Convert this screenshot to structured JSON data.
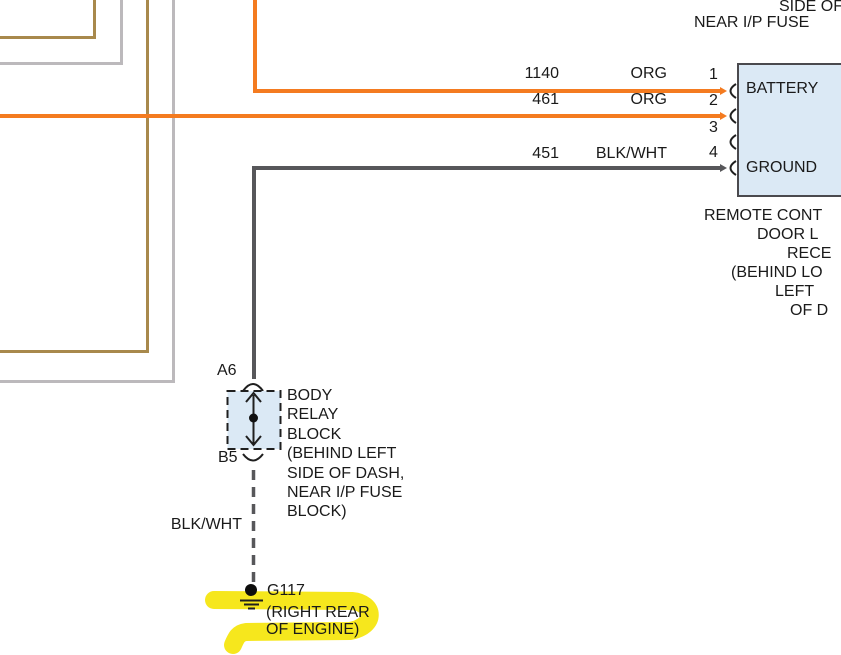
{
  "colors": {
    "orange": "#F47B20",
    "tan": "#A8894C",
    "light_gray": "#BCB9BC",
    "dark_gray": "#57575A",
    "box_fill": "#DBE9F5",
    "box_border": "#4A4A4E",
    "line_black": "#1F1F1F",
    "highlight_yellow": "#F5E50A",
    "text": "#1A1A1A"
  },
  "top_note": {
    "line1": "SIDE OF",
    "line2": "NEAR I/P FUSE"
  },
  "receiver": {
    "pin1_label": "BATTERY",
    "pin4_label": "GROUND",
    "pins": [
      {
        "num": "1",
        "circuit": "1140",
        "wire_color": "ORG"
      },
      {
        "num": "2",
        "circuit": "461",
        "wire_color": "ORG"
      },
      {
        "num": "3",
        "circuit": "",
        "wire_color": ""
      },
      {
        "num": "4",
        "circuit": "451",
        "wire_color": "BLK/WHT"
      }
    ],
    "caption_lines": [
      "REMOTE CONT",
      "DOOR L",
      "RECE",
      "(BEHIND LO",
      "LEFT",
      "OF D"
    ]
  },
  "body_relay_block": {
    "top_pin": "A6",
    "bottom_pin": "B5",
    "label_lines": [
      "BODY",
      "RELAY",
      "BLOCK",
      "(BEHIND LEFT",
      "SIDE OF DASH,",
      "NEAR I/P FUSE",
      "BLOCK)"
    ]
  },
  "ground": {
    "wire_label": "BLK/WHT",
    "name": "G117",
    "location_line1": "(RIGHT REAR",
    "location_line2": "OF ENGINE)"
  }
}
